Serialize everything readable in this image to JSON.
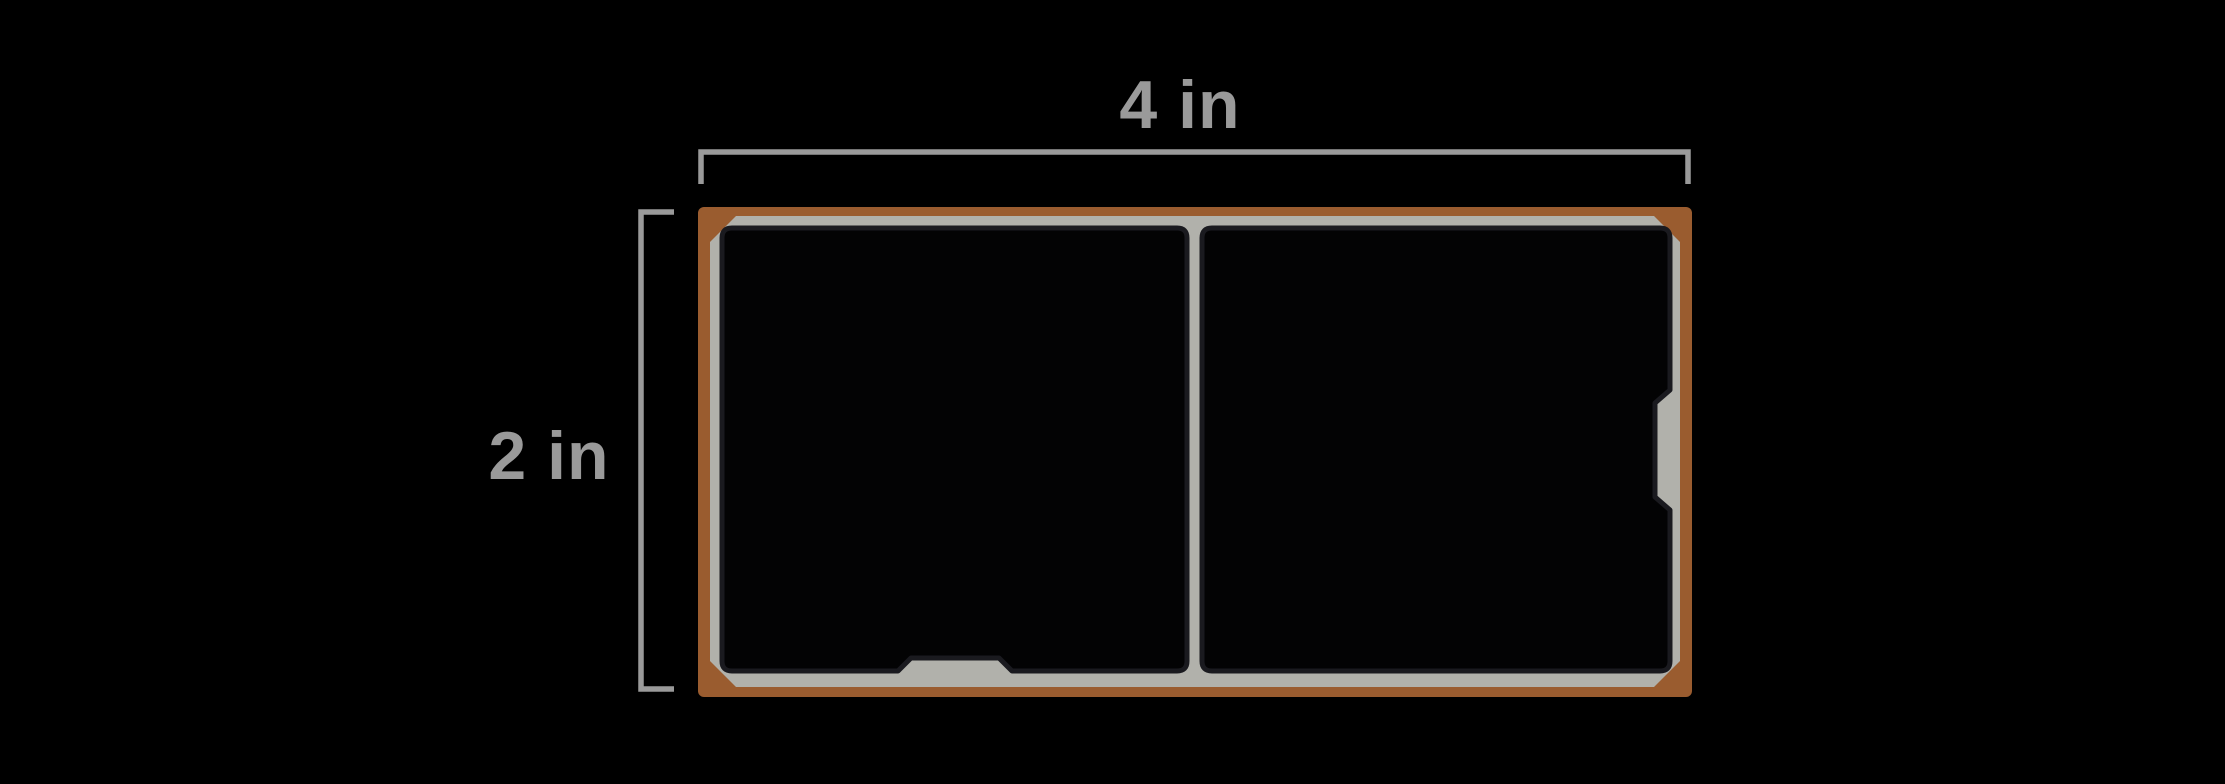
{
  "diagram": {
    "width_label": "4 in",
    "height_label": "2 in"
  },
  "colors": {
    "background": "#000000",
    "frame": "#9a5c2f",
    "pan": "#b1b1ab",
    "panel_fill": "#030304",
    "panel_outline": "#1a1a1f",
    "dimension": "#9a9a9a",
    "label_text": "#9a9a9a"
  }
}
